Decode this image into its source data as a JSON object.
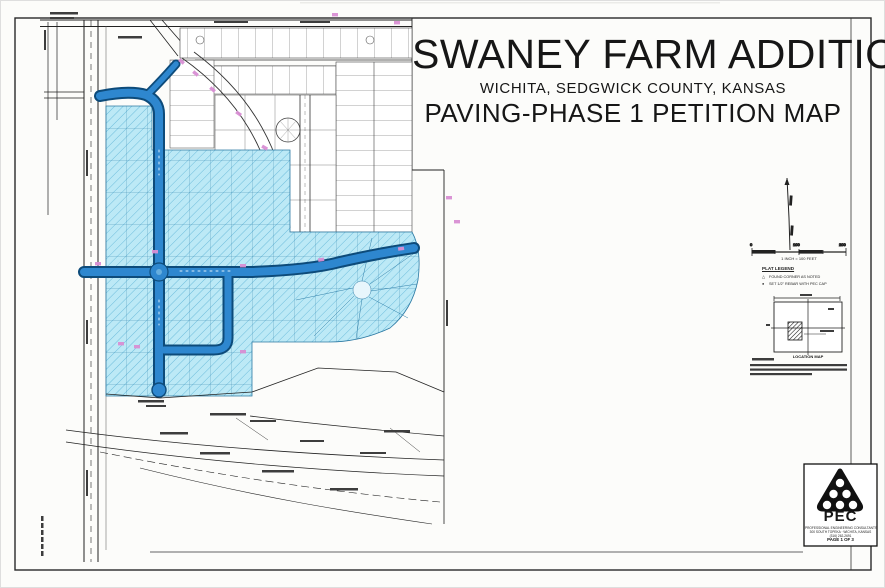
{
  "title_block": {
    "line1": "SWANEY FARM ADDITION",
    "line2": "WICHITA, SEDGWICK COUNTY, KANSAS",
    "line3": "PAVING-PHASE 1 PETITION MAP"
  },
  "scale_bar": {
    "ticks": [
      "0",
      "100",
      "200"
    ],
    "label": "1 INCH = 100 FEET"
  },
  "legend": {
    "heading": "PLAT LEGEND",
    "items": [
      {
        "symbol": "△",
        "label": "FOUND CORNER AS NOTED"
      },
      {
        "symbol": "●",
        "label": "SET 1/2\" REBAR WITH PEC CAP"
      }
    ]
  },
  "location_map": {
    "label": "LOCATION MAP"
  },
  "logo_block": {
    "name": "PEC",
    "lines": [
      "PROFESSIONAL ENGINEERING CONSULTANTS",
      "300 SOUTH TOPEKA  ·  WICHITA, KANSAS",
      "(316) 262-2691"
    ],
    "page_label": "PAGE 1 OF 3"
  },
  "colors": {
    "street_blue": "#2e87cf",
    "parcel_cyan": "#bce9f6",
    "mark_pink": "#d98fd4"
  }
}
